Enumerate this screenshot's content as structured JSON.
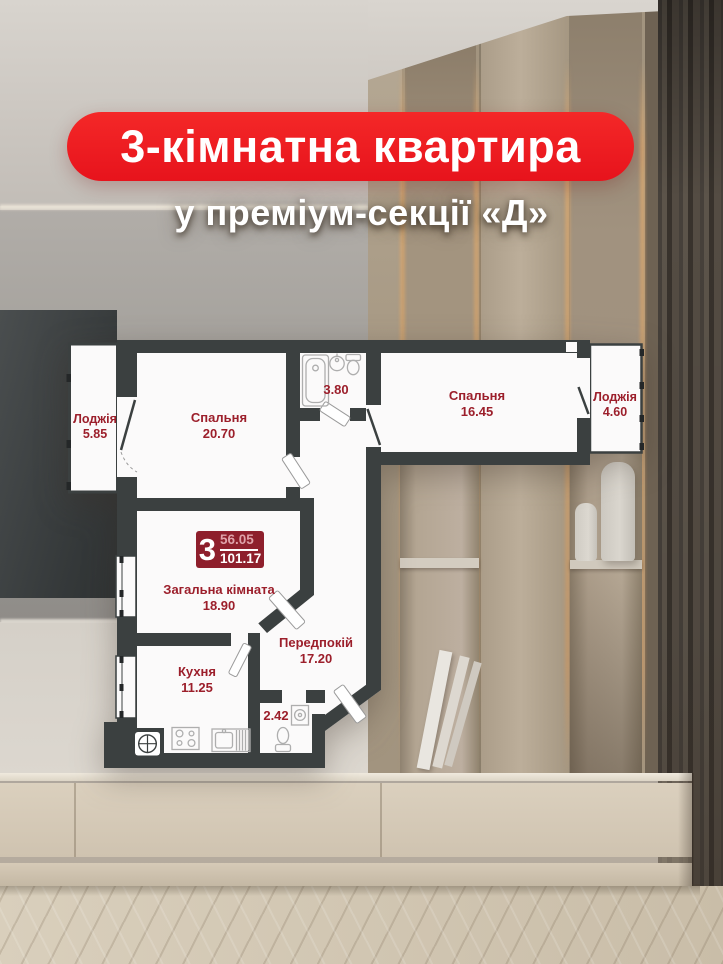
{
  "header": {
    "title": "3-кімнатна квартира",
    "subtitle": "у преміум-секції «Д»"
  },
  "badge": {
    "rooms": "3",
    "living_area": "56.05",
    "total_area": "101.17"
  },
  "plan": {
    "rooms": [
      {
        "id": "loggia-left",
        "name": "Лоджія",
        "area": "5.85"
      },
      {
        "id": "bedroom-1",
        "name": "Спальня",
        "area": "20.70"
      },
      {
        "id": "bathroom",
        "name": "",
        "area": "3.80"
      },
      {
        "id": "bedroom-2",
        "name": "Спальня",
        "area": "16.45"
      },
      {
        "id": "loggia-right",
        "name": "Лоджія",
        "area": "4.60"
      },
      {
        "id": "living-room",
        "name": "Загальна кімната",
        "area": "18.90"
      },
      {
        "id": "hallway",
        "name": "Передпокій",
        "area": "17.20"
      },
      {
        "id": "kitchen",
        "name": "Кухня",
        "area": "11.25"
      },
      {
        "id": "wc",
        "name": "",
        "area": "2.42"
      }
    ]
  },
  "colors": {
    "banner_red": "#ec1b23",
    "badge_red": "#8e1f2c",
    "label_red": "#9c1f2b",
    "wall_dark": "#3b4040",
    "plan_white": "#fbfafa"
  }
}
